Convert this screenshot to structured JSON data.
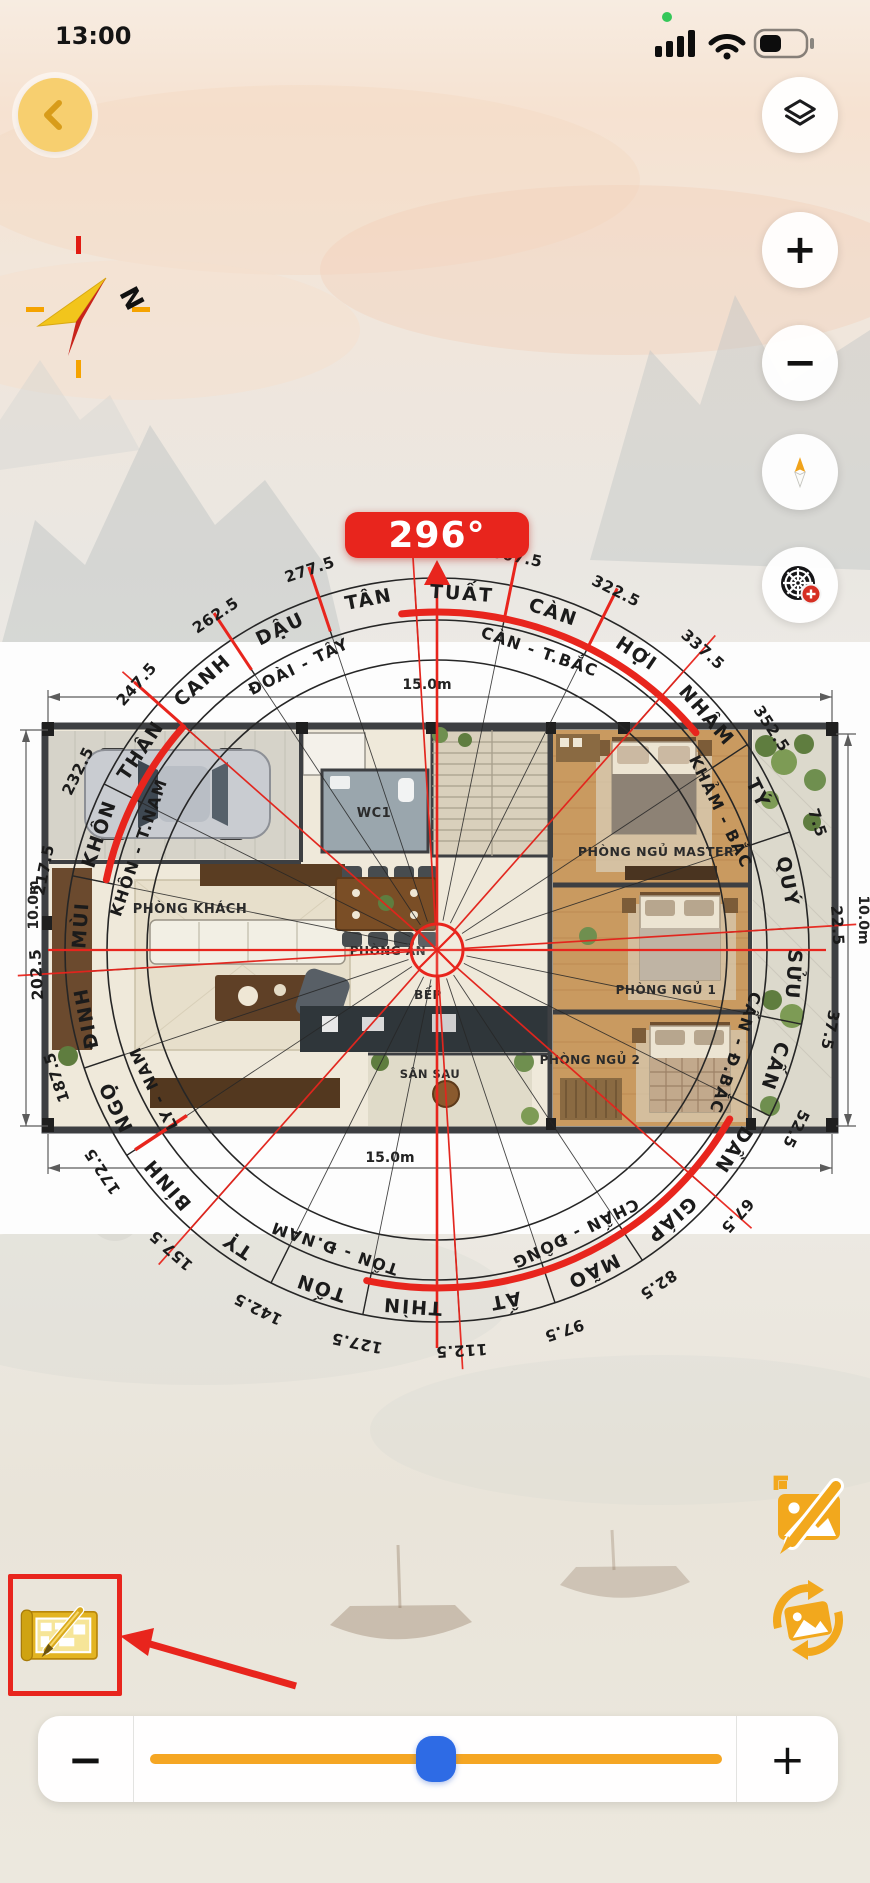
{
  "status_bar": {
    "time": "13:00"
  },
  "header": {
    "heading_badge": "296°"
  },
  "mini_compass": {
    "north_label": "N"
  },
  "map_buttons": {
    "zoom_in": "+",
    "zoom_out": "−"
  },
  "compass": {
    "heading_degrees": 296,
    "accent_red": "#e8251d",
    "mountain_ring": [
      "TÝ",
      "QUÝ",
      "SỬU",
      "CẤN",
      "DẦN",
      "GIÁP",
      "MÃO",
      "ẤT",
      "THÌN",
      "TỐN",
      "TỴ",
      "BÍNH",
      "NGỌ",
      "ĐINH",
      "MÙI",
      "KHÔN",
      "THÂN",
      "CANH",
      "DẬU",
      "TÂN",
      "TUẤT",
      "CÀN",
      "HỢI",
      "NHÂM"
    ],
    "direction_ring": [
      "KHẢM - BẮC",
      "CẤN - Đ.BẮC",
      "CHẤN - ĐÔNG",
      "TỐN - Đ.NAM",
      "LY - NAM",
      "KHÔN - T.NAM",
      "ĐOÀI - TÂY",
      "CÀN - T.BẮC"
    ],
    "degree_ticks": [
      7.5,
      22.5,
      37.5,
      52.5,
      67.5,
      82.5,
      97.5,
      112.5,
      127.5,
      142.5,
      157.5,
      172.5,
      187.5,
      202.5,
      217.5,
      232.5,
      247.5,
      262.5,
      277.5,
      292.5,
      307.5,
      322.5,
      337.5,
      352.5
    ]
  },
  "floor_plan": {
    "rooms": {
      "living": "PHÒNG KHÁCH",
      "dining": "PHÒNG ĂN",
      "kitchen": "BẾP",
      "back_yard": "SÂN SAU",
      "wc": "WC1",
      "master_bedroom": "PHÒNG NGỦ MASTER",
      "bedroom1": "PHÒNG NGỦ 1",
      "bedroom2": "PHÒNG NGỦ 2"
    },
    "dimensions": {
      "top": "15.0m",
      "bottom": "15.0m",
      "left": "10.0m",
      "right": "10.0m"
    }
  },
  "slider": {
    "minus": "−",
    "plus": "+",
    "value_percent": 45,
    "track_color": "#f5a623",
    "thumb_color": "#2e6be5"
  }
}
